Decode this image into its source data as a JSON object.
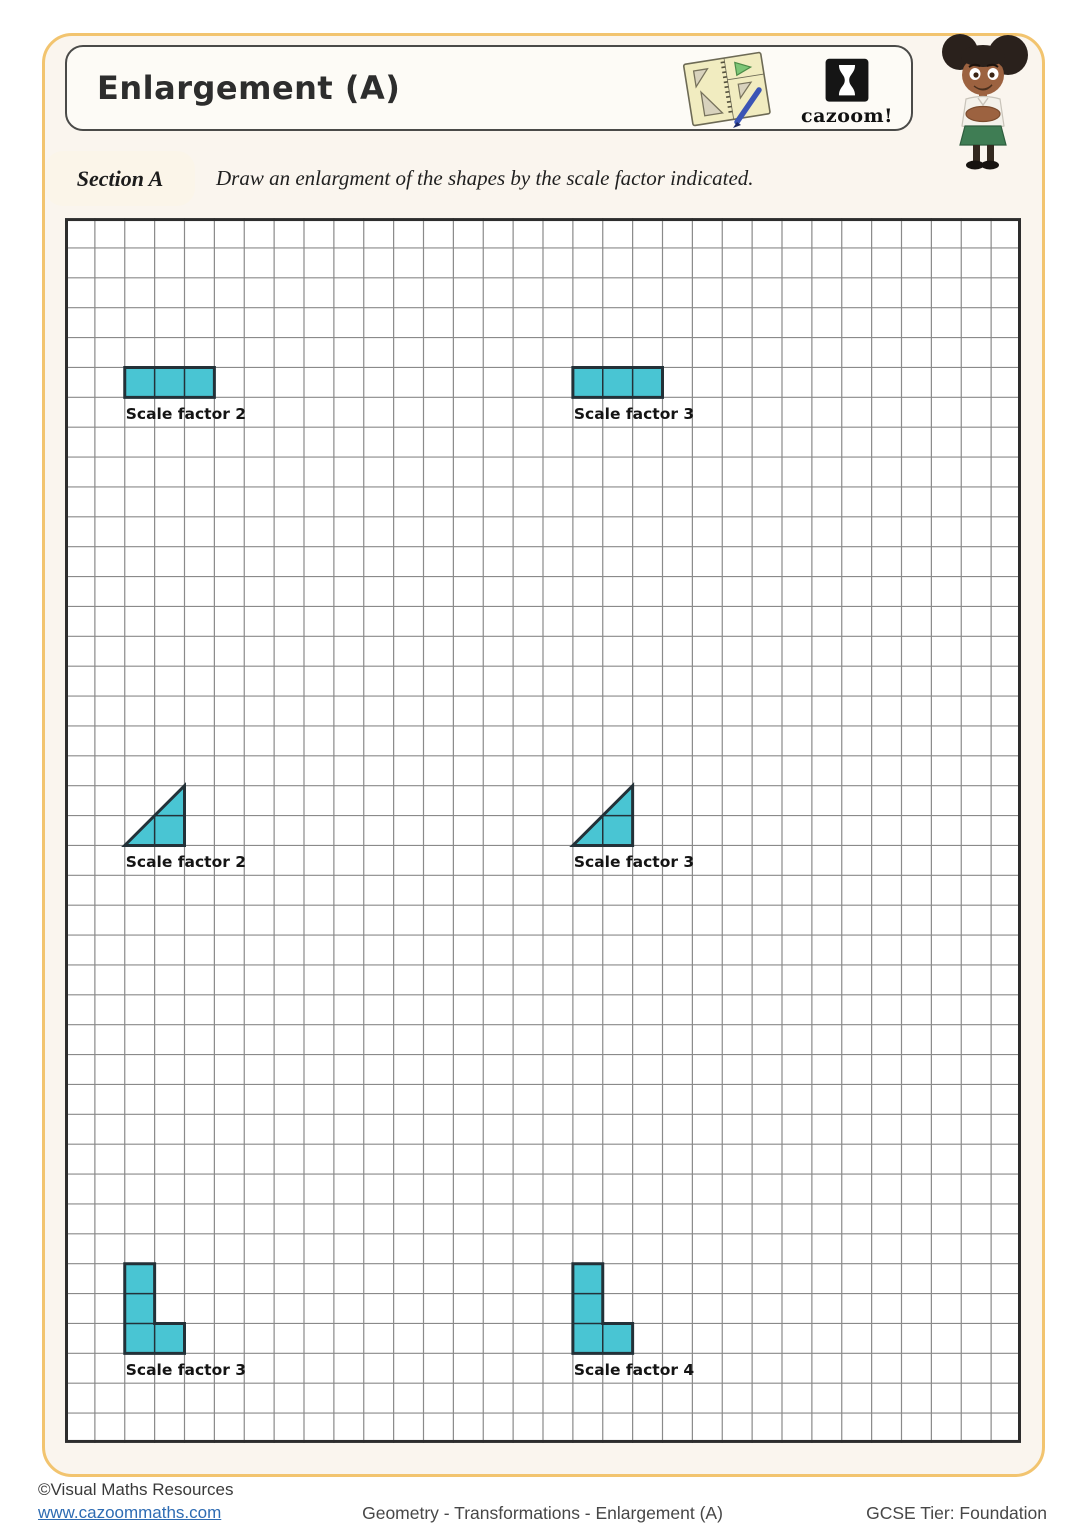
{
  "header": {
    "title": "Enlargement (A)",
    "logo_text": "cazoom!"
  },
  "section": {
    "label": "Section A",
    "instruction": "Draw an enlargment of the shapes by the scale factor indicated."
  },
  "grid": {
    "cols": 32,
    "rows": 41,
    "cell_px": 29.875,
    "line_color": "#8a8a8a",
    "border_color": "#2d2d2d",
    "background": "#ffffff"
  },
  "colors": {
    "shape_fill": "#49c5d3",
    "shape_stroke": "#233138",
    "shape_inner_line": "#223138",
    "frame_border": "#f2c46f",
    "page_bg": "#faf5ee",
    "label_color": "#141414"
  },
  "shapes": [
    {
      "type": "rectangle",
      "col": 2,
      "row": 5,
      "width": 3,
      "height": 1,
      "label": "Scale factor 2"
    },
    {
      "type": "rectangle",
      "col": 17,
      "row": 5,
      "width": 3,
      "height": 1,
      "label": "Scale factor 3"
    },
    {
      "type": "right-triangle",
      "col": 2,
      "row": 19,
      "width": 2,
      "height": 2,
      "label": "Scale factor 2"
    },
    {
      "type": "right-triangle",
      "col": 17,
      "row": 19,
      "width": 2,
      "height": 2,
      "label": "Scale factor 3"
    },
    {
      "type": "l-shape",
      "col": 2,
      "row": 35,
      "width": 2,
      "height": 3,
      "label": "Scale factor 3"
    },
    {
      "type": "l-shape",
      "col": 17,
      "row": 35,
      "width": 2,
      "height": 3,
      "label": "Scale factor 4"
    }
  ],
  "footer": {
    "copyright": "©Visual Maths Resources",
    "website": "www.cazoommaths.com",
    "breadcrumb": "Geometry - Transformations - Enlargement (A)",
    "tier": "GCSE Tier: Foundation"
  }
}
